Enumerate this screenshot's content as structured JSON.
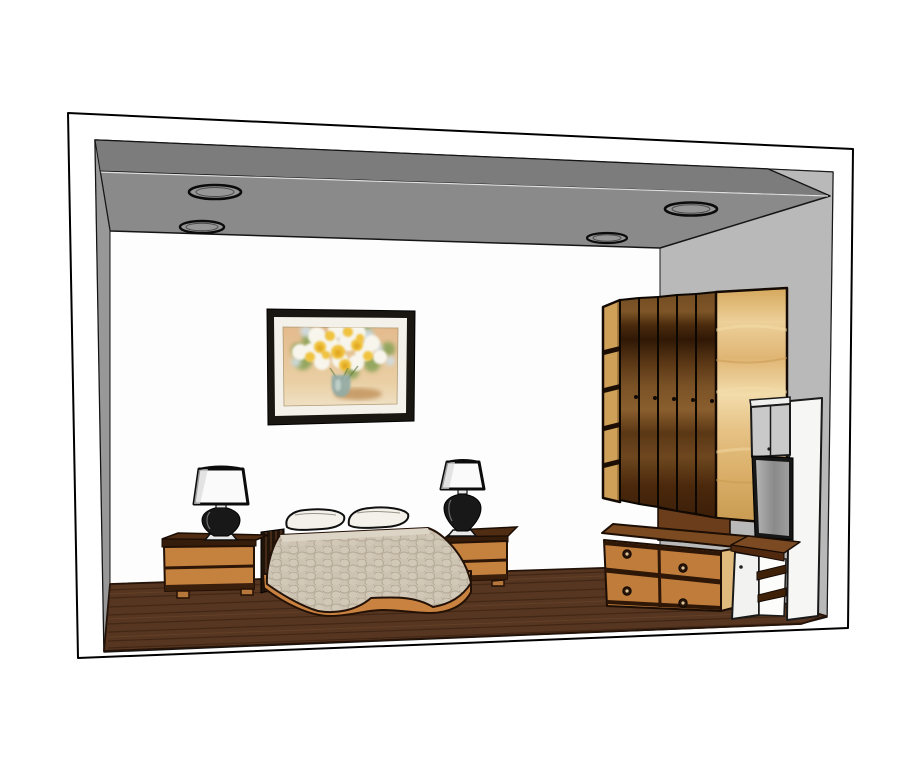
{
  "scene": {
    "type": "3d-room-render",
    "room": "bedroom interior, SketchUp-style cutaway view",
    "objects": {
      "ceiling_lights": 4,
      "wall_paintings": 1,
      "pillows": 2,
      "nightstands": 2,
      "table_lamps": 2,
      "wardrobe_doors": 5,
      "wardrobe_side_shelves": 4,
      "chest_drawers": 4,
      "chest_knobs": 4,
      "tv_screens": 1,
      "open_shelf_boards": 2
    },
    "colors": {
      "background": "#ffffff",
      "frame_white": "#ffffff",
      "outline_black": "#000000",
      "back_wall": "#fdfdfd",
      "ceiling_main": "#8a8a8a",
      "ceiling_fascia": "#7c7c7c",
      "ceiling_seam": "#e0e0e0",
      "left_wall": "#989898",
      "right_wall": "#b9b9b9",
      "floor_wood": "#563521",
      "floor_streak": "#331d0c",
      "light_inner": "#969696",
      "painting_frame": "#1a1611",
      "painting_mat": "#f4f1ea",
      "flower_yellow": "#f0c23c",
      "flower_deep_yellow": "#dfa21e",
      "flower_white": "#f7f5ec",
      "flower_blue": "#cfdde4",
      "foliage_green": "#85a055",
      "vase_teal": "#93aca7",
      "bedspread": "#cdc3b3",
      "bedspread_top": "#dcd4c5",
      "pillow_white": "#f3f1ea",
      "bed_base_orange": "#c9823f",
      "headboard_dark": "#20130a",
      "nightstand_top": "#4f2c12",
      "nightstand_front": "#c5813e",
      "nightstand_trim": "#351c0b",
      "lamp_shade": "#fafafa",
      "lamp_body": "#181818",
      "lamp_base": "#e8e8e8",
      "wardrobe_shelf_col": "#cfa057",
      "wardrobe_lower_panel": "#6b3d1b",
      "chest_top": "#7b4a20",
      "chest_front": "#bf7c3b",
      "chest_side": "#e0ba7d",
      "chest_trim": "#2e1707",
      "knob_dark": "#2a1508",
      "knob_center": "#d8c49a",
      "tv_cabinet_gray": "#c9c9c9",
      "tv_frame": "#161616",
      "unit_white": "#f6f6f4",
      "shelf_wood_top": "#7b4a22",
      "shelf_board_dark": "#3f2108"
    }
  }
}
